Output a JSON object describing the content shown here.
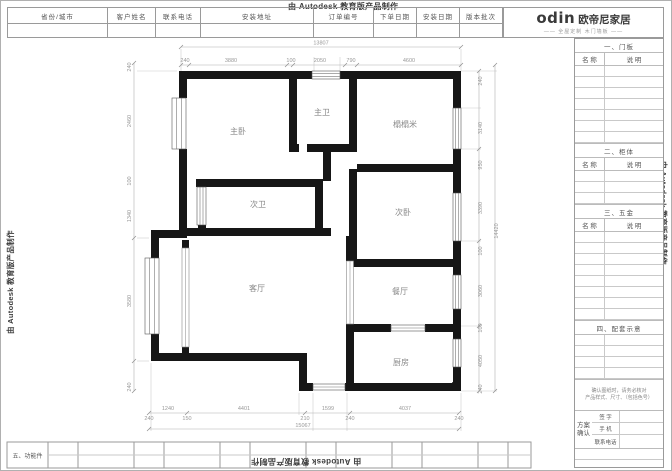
{
  "watermark_text": "由 Autodesk 教育版产品制作",
  "header": {
    "fields": [
      "省份/城市",
      "客户姓名",
      "联系电话",
      "安装地址",
      "订单编号",
      "下单日期",
      "安装日期",
      "版本批次"
    ]
  },
  "logo": {
    "brand": "odin",
    "name": "欧帝尼家居",
    "tagline": "—— 全屋定制 木门墙板 ——"
  },
  "sidebar": {
    "sections": [
      {
        "title": "一、门板",
        "col1": "名 称",
        "col2": "说 明"
      },
      {
        "title": "二、柜体",
        "col1": "名 称",
        "col2": "说 明"
      },
      {
        "title": "三、五金",
        "col1": "名 称",
        "col2": "说 明"
      },
      {
        "title": "四、配套示意"
      }
    ],
    "note_line1": "确认图纸时，请务必核对",
    "note_line2": "产品样式、尺寸、（包括色号）",
    "confirm_line1": "方案",
    "confirm_line2": "确认",
    "confirm_rows": [
      "签 字",
      "手 机",
      "联系电话"
    ]
  },
  "bottom_table": {
    "label": "五、功能件"
  },
  "plan": {
    "rooms": [
      "主卧",
      "主卫",
      "榻榻米",
      "次卫",
      "次卧",
      "客厅",
      "餐厅",
      "厨房"
    ],
    "dims": {
      "top_total": "13807",
      "top": [
        "240",
        "3880",
        "100",
        "2050",
        "790",
        "4600"
      ],
      "right": [
        "240",
        "3140",
        "950",
        "3390",
        "100",
        "3060",
        "100",
        "4050",
        "240"
      ],
      "right_total": "14420",
      "left": [
        "240",
        "2460",
        "100",
        "1340",
        "3580",
        "240"
      ],
      "bottom1": [
        "1240",
        "4401",
        "1599",
        "4037"
      ],
      "bottom2": [
        "240",
        "150",
        "210",
        "240",
        "240"
      ],
      "bottom_total": "15067"
    }
  }
}
